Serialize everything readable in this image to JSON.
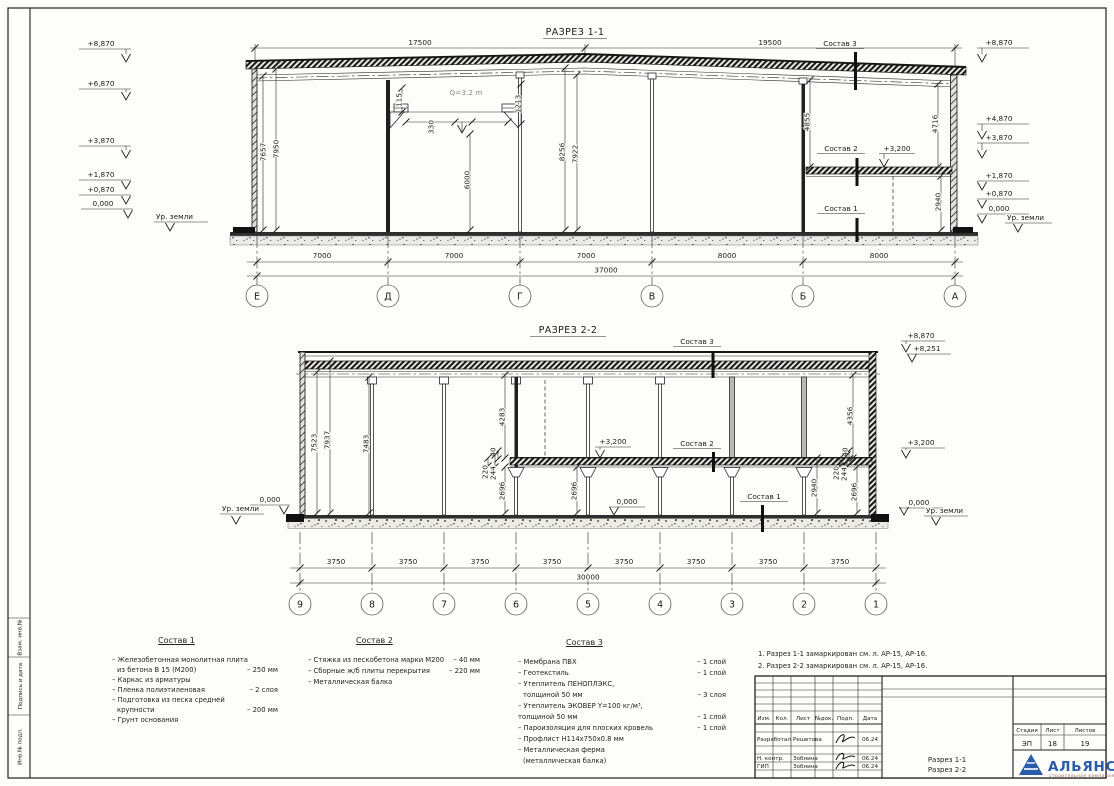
{
  "colors": {
    "line": "#222222",
    "logo_blue": "#2a5caa",
    "logo_sub": "#a06a62"
  },
  "drawing": {
    "section1": {
      "title": "РАЗРЕЗ 1-1",
      "top_dims": [
        "17500",
        "19500"
      ],
      "left_elev": [
        "+8,870",
        "+6,870",
        "+3,870",
        "+1,870",
        "+0,870",
        "0,000"
      ],
      "right_elev": [
        "+8,870",
        "+4,870",
        "+3,870",
        "+1,870",
        "+0,870",
        "0,000"
      ],
      "ground_label": "Ур. земли",
      "dims": {
        "w1": "7657",
        "w2": "7950",
        "c115": "115",
        "crane": "Q=3.2 m",
        "c1213": "1213",
        "c330": "330",
        "c6000": "6000",
        "m8256": "8256",
        "m7922": "7922",
        "r4855": "4855",
        "r4716": "4716",
        "r2940": "2940"
      },
      "callout_s3": "Состав 3",
      "callout_s2": "Состав 2",
      "callout_s1": "Состав 1",
      "elev_3200": "+3,200",
      "bottom_dims": [
        "7000",
        "7000",
        "7000",
        "8000",
        "8000"
      ],
      "total": "37000",
      "axes": [
        "Е",
        "Д",
        "Г",
        "В",
        "Б",
        "А"
      ]
    },
    "section2": {
      "title": "РАЗРЕЗ 2-2",
      "elev": {
        "e8870": "+8,870",
        "e8251": "+8,251",
        "e3200": "+3,200",
        "e0": "0,000",
        "ground": "Ур. земли"
      },
      "dims": {
        "l7523": "7523",
        "l7937": "7937",
        "l7483": "7483",
        "m4283": "4283",
        "m40": "40",
        "m220": "220",
        "m244": "244",
        "m2696a": "2696",
        "m2696b": "2696",
        "r4356": "4356",
        "r40": "40",
        "r220": "220",
        "r244": "244",
        "r2940": "2940",
        "r2696": "2696"
      },
      "callout_s3": "Состав 3",
      "callout_s2": "Состав 2",
      "callout_s1": "Состав 1",
      "bottom_dims": [
        "3750",
        "3750",
        "3750",
        "3750",
        "3750",
        "3750",
        "3750",
        "3750"
      ],
      "total": "30000",
      "axes": [
        "9",
        "8",
        "7",
        "6",
        "5",
        "4",
        "3",
        "2",
        "1"
      ]
    }
  },
  "legend": {
    "s1": {
      "title": "Состав 1",
      "rows": [
        {
          "t": "– Железобетонная  монолитная плита",
          "v": ""
        },
        {
          "t": "из бетона В 15 (М200)",
          "v": "– 250 мм"
        },
        {
          "t": "– Каркас из арматуры",
          "v": ""
        },
        {
          "t": "– Пленка полиэтиленовая",
          "v": "– 2 слоя"
        },
        {
          "t": "– Подготовка из песка средней",
          "v": ""
        },
        {
          "t": "крупности",
          "v": "– 200 мм"
        },
        {
          "t": "– Грунт основания",
          "v": ""
        }
      ]
    },
    "s2": {
      "title": "Состав 2",
      "rows": [
        {
          "t": "– Стяжка из пескобетона марки М200",
          "v": "– 40 мм"
        },
        {
          "t": "– Сборные ж/б плиты перекрытия",
          "v": "– 220 мм"
        },
        {
          "t": "– Металлическая балка",
          "v": ""
        }
      ]
    },
    "s3": {
      "title": "Состав 3",
      "rows": [
        {
          "t": "– Мембрана ПВХ",
          "v": "– 1 слой"
        },
        {
          "t": "– Геотекстиль",
          "v": "– 1 слой"
        },
        {
          "t": "– Утеплитель ПЕНОПЛЭКС,",
          "v": ""
        },
        {
          "t": "толщиной 50 мм",
          "v": "– 3 слоя"
        },
        {
          "t": "– Утеплитель ЭКОВЕР Y=100 кг/м³,",
          "v": ""
        },
        {
          "t": "толщиной 50 мм",
          "v": "– 1 слой"
        },
        {
          "t": "– Пароизоляция для плоских кровель",
          "v": "– 1 слой"
        },
        {
          "t": "– Профлист  Н114х750х0.8 мм",
          "v": ""
        },
        {
          "t": "– Металлическая ферма",
          "v": ""
        },
        {
          "t": "(металлическая балка)",
          "v": ""
        }
      ]
    }
  },
  "notes": [
    "1. Разрез 1-1 замаркирован см. л. АР-15, АР-16.",
    "2. Разрез 2-2 замаркирован см. л. АР-15, АР-16."
  ],
  "titleblock": {
    "headers": [
      "Изм.",
      "Кол.",
      "Лист",
      "№док.",
      "Подп.",
      "Дата"
    ],
    "rows": [
      {
        "role": "Разработал",
        "name": "Решетова",
        "date": "06.24"
      },
      {
        "role": "Н. контр.",
        "name": "Зобнина",
        "date": "06.24"
      },
      {
        "role": "ГИП",
        "name": "Зобнина",
        "date": "06.24"
      }
    ],
    "doc_line1": "Разрез 1-1",
    "doc_line2": "Разрез 2-2",
    "stage_headers": [
      "Стадия",
      "Лист",
      "Листов"
    ],
    "stage_values": [
      "ЭП",
      "18",
      "19"
    ],
    "logo_name": "АЛЬЯНС",
    "logo_sub": "строительная компания"
  },
  "side_strip": [
    "Взам. инв.№",
    "Подпись и дата",
    "Инв.№ подл."
  ]
}
